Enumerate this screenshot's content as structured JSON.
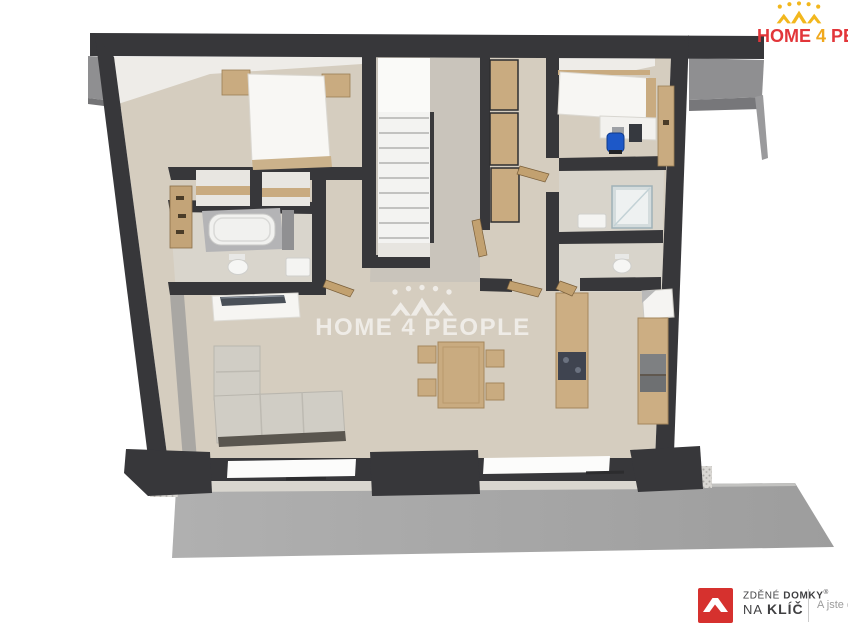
{
  "canvas": {
    "width": 848,
    "height": 636,
    "background": "#ffffff"
  },
  "watermark": {
    "text": "HOME 4 PEOPLE",
    "color": "rgba(255,255,255,0.62)"
  },
  "header_logo": {
    "word1": "HOME",
    "word2": "4",
    "word3": "PEOPLE",
    "red": "#e2363a",
    "yellow": "#f0a81c",
    "crown_color": "#f2b71d"
  },
  "footer_logo": {
    "line1_light": "ZDĚNÉ",
    "line1_bold": "DOMKY",
    "registered": "®",
    "line2_light": "NA",
    "line2_bold": "KLÍČ",
    "tagline": "A jste d",
    "square_color": "#d6312e",
    "text_color": "#3f3f41",
    "tagline_color": "#9b9b9b"
  },
  "floorplan_palette": {
    "wall": "#37373a",
    "floor": "#d5cdbf",
    "floor_gray": "#c9c4bb",
    "terrace": "#a8a8a8",
    "roof_overhang": "#8f8f91",
    "wood": "#c9ab80",
    "sofa": "#d0cdc5",
    "white_furniture": "#f6f5f2",
    "office_chair_blue": "#1d58c8",
    "appliance_gray": "#7e8082",
    "cooktop_dark": "#3f4450",
    "shower_glass": "#dfe8ea"
  }
}
